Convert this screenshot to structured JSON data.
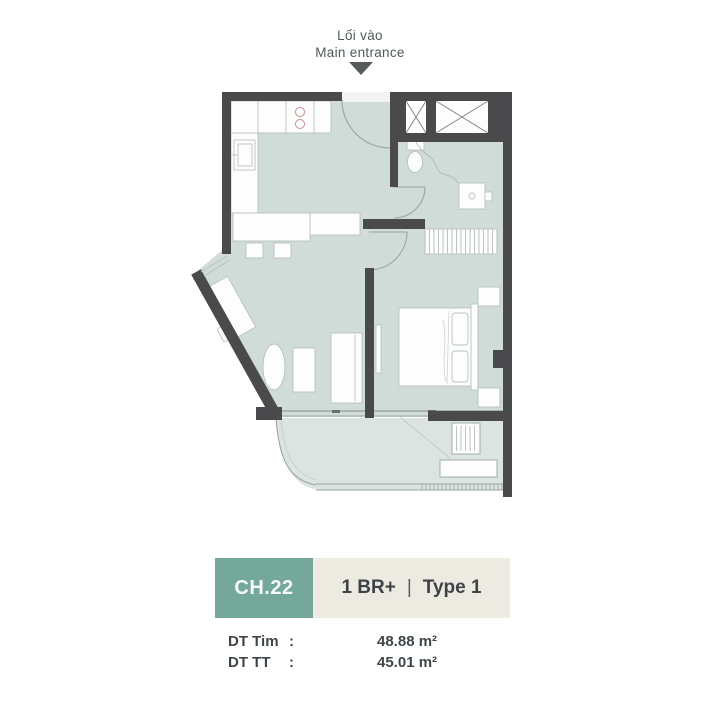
{
  "entrance": {
    "label_vi": "Lối vào",
    "label_en": "Main entrance"
  },
  "unit_card": {
    "code": "CH.22",
    "bedrooms": "1 BR+",
    "divider": "|",
    "type": "Type 1",
    "areas": [
      {
        "label": "DT Tim",
        "colon": ":",
        "value": "48.88 m²"
      },
      {
        "label": "DT TT",
        "colon": ":",
        "value": "45.01 m²"
      }
    ]
  },
  "colors": {
    "wall": "#4a4a4c",
    "floor": "#cfdcd7",
    "balcony_floor": "#dbe4e0",
    "accent_teal": "#74a89b",
    "card_beige": "#edeae2",
    "text_dark": "#3f464a",
    "label_gray": "#4f5a57",
    "furniture_stroke": "#b8c2bf",
    "furniture_fill": "#fdfdfd"
  },
  "floor_plan": {
    "rooms": [
      "kitchen",
      "living-dining",
      "hallway",
      "bathroom",
      "bedroom",
      "balcony",
      "technical-shafts"
    ],
    "fixtures": [
      "kitchen-counter",
      "stove",
      "sink",
      "dining-table",
      "desk",
      "oval-side-table",
      "sofa",
      "coffee-table",
      "tv",
      "wardrobe",
      "bed",
      "nightstands",
      "toilet",
      "wash-basin",
      "ac-unit",
      "entrance-door",
      "bedroom-door",
      "bathroom-door",
      "balcony-railing"
    ]
  }
}
